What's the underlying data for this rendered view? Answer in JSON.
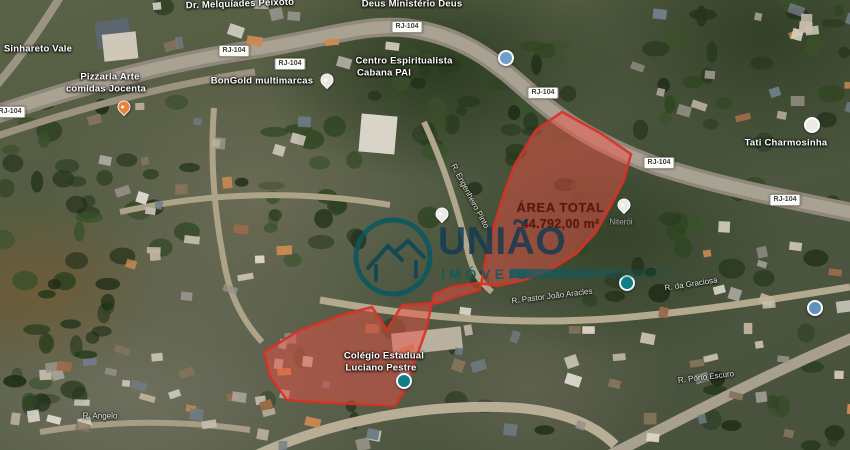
{
  "area_total": {
    "title": "ÁREA TOTAL",
    "value": "44.792,00 m²"
  },
  "watermark": {
    "brand": "UNIÃO",
    "word": "IMÓVEIS",
    "accent_color": "#095d63",
    "text_color": "#133a52"
  },
  "highlight": {
    "fill": "#f05045",
    "fill_opacity": 0.48,
    "stroke": "#d93025",
    "path": "M562,112 L600,133 L631,154 L624,180 L610,207 L596,232 L577,253 L552,269 L524,280 L498,286 L478,283 L452,287 L434,294 L426,330 L405,390 L395,406 L330,403 L287,400 L270,377 L264,352 L300,330 L342,315 L372,307 L387,330 L402,305 L438,303 L458,296 L480,290 L486,258 L494,226 L503,196 L515,164 L536,130 Z"
  },
  "road_badges": [
    {
      "label": "RJ-104",
      "x": 10,
      "y": 112
    },
    {
      "label": "RJ-104",
      "x": 234,
      "y": 51
    },
    {
      "label": "RJ-104",
      "x": 290,
      "y": 64
    },
    {
      "label": "RJ-104",
      "x": 407,
      "y": 27
    },
    {
      "label": "RJ-104",
      "x": 543,
      "y": 93
    },
    {
      "label": "RJ-104",
      "x": 659,
      "y": 163
    },
    {
      "label": "RJ-104",
      "x": 785,
      "y": 200
    }
  ],
  "labels": [
    {
      "text": "Dr. Melquíades Peixoto",
      "x": 240,
      "y": 4,
      "rot": -2,
      "kind": "place"
    },
    {
      "text": "Deus Ministério Deus",
      "x": 412,
      "y": 4,
      "rot": 0,
      "kind": "place"
    },
    {
      "text": "Sinhareto Vale",
      "x": 38,
      "y": 49,
      "rot": 0,
      "kind": "place"
    },
    {
      "text": "Pizzaria Arte",
      "x": 110,
      "y": 77,
      "rot": 0,
      "kind": "place"
    },
    {
      "text": "comidas Jocenta",
      "x": 106,
      "y": 89,
      "rot": 0,
      "kind": "place"
    },
    {
      "text": "BonGold multimarcas",
      "x": 262,
      "y": 81,
      "rot": 0,
      "kind": "place"
    },
    {
      "text": "Centro Espiritualista",
      "x": 404,
      "y": 61,
      "rot": 0,
      "kind": "place"
    },
    {
      "text": "Cabana PAI",
      "x": 384,
      "y": 73,
      "rot": 0,
      "kind": "place"
    },
    {
      "text": "Tati Charmosinha",
      "x": 786,
      "y": 143,
      "rot": 0,
      "kind": "place"
    },
    {
      "text": "Niterói",
      "x": 621,
      "y": 222,
      "rot": 0,
      "kind": "faint"
    },
    {
      "text": "Colégio Estadual",
      "x": 384,
      "y": 356,
      "rot": 0,
      "kind": "place"
    },
    {
      "text": "Luciano Pestre",
      "x": 381,
      "y": 368,
      "rot": 0,
      "kind": "place"
    },
    {
      "text": "R. Angelo",
      "x": 100,
      "y": 416,
      "rot": 0,
      "kind": "street"
    },
    {
      "text": "R. Pastor João Aracles",
      "x": 552,
      "y": 296,
      "rot": -7,
      "kind": "street"
    },
    {
      "text": "R. da Graciosa",
      "x": 691,
      "y": 284,
      "rot": -9,
      "kind": "street"
    },
    {
      "text": "R. Porto Escuro",
      "x": 706,
      "y": 377,
      "rot": -7,
      "kind": "street"
    },
    {
      "text": "R. Engenheiro Pinto",
      "x": 470,
      "y": 196,
      "rot": 62,
      "kind": "street"
    }
  ],
  "pins": [
    {
      "name": "restaurant-pin",
      "shape": "drop",
      "x": 124,
      "y": 107,
      "color": "#e8833a"
    },
    {
      "name": "place-pin",
      "shape": "drop",
      "x": 327,
      "y": 80,
      "color": "#e9e7e2"
    },
    {
      "name": "transit-icon",
      "shape": "circ",
      "x": 506,
      "y": 58,
      "color": "#6f9fc6"
    },
    {
      "name": "poi-circle",
      "shape": "circ",
      "x": 812,
      "y": 125,
      "color": "#eceae4"
    },
    {
      "name": "place-pin",
      "shape": "drop",
      "x": 624,
      "y": 205,
      "color": "#eceae4"
    },
    {
      "name": "place-pin",
      "shape": "drop",
      "x": 442,
      "y": 214,
      "color": "#eceae4"
    },
    {
      "name": "poi-teal-icon",
      "shape": "circ",
      "x": 627,
      "y": 283,
      "color": "#0f7f86"
    },
    {
      "name": "school-icon",
      "shape": "circ",
      "x": 404,
      "y": 381,
      "color": "#0f7f86"
    },
    {
      "name": "poi-blue-icon",
      "shape": "circ",
      "x": 815,
      "y": 308,
      "color": "#5f93bb"
    }
  ]
}
